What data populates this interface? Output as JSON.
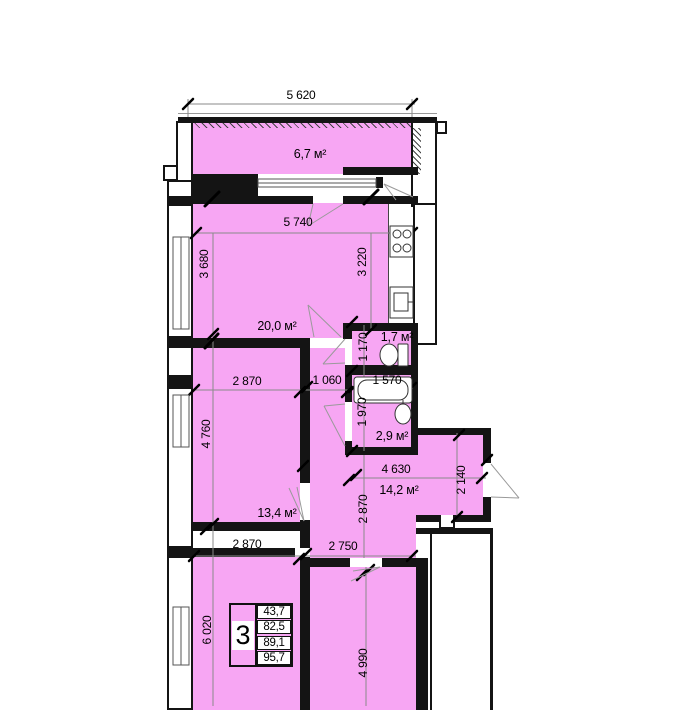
{
  "plan": {
    "colors": {
      "room_fill": "#f7a6f3",
      "wall": "#141414"
    },
    "areas": {
      "balcony": "6,7 м²",
      "kitchen_living": "20,0 м²",
      "wc": "1,7 м²",
      "bathroom": "2,9 м²",
      "bedroom_mid": "13,4 м²",
      "hall": "14,2 м²"
    },
    "dimensions": {
      "top_width": "5 620",
      "living_width": "5 740",
      "living_height_left": "3 680",
      "living_height_right": "3 220",
      "wc_height": "1 170",
      "corridor_width": "1 060",
      "bath_width": "1 570",
      "bath_height": "1 970",
      "mid_room_width": "2 870",
      "mid_room_height": "4 760",
      "hall_width": "4 630",
      "hall_entry_height": "2 140",
      "hall_height": "2 870",
      "bottom_left_width": "2 870",
      "bottom_right_width": "2 750",
      "bottom_left_height": "6 020",
      "bottom_right_height": "4 990"
    },
    "info_table": {
      "rooms_count": "3",
      "areas": [
        "43,7",
        "82,5",
        "89,1",
        "95,7"
      ]
    }
  }
}
